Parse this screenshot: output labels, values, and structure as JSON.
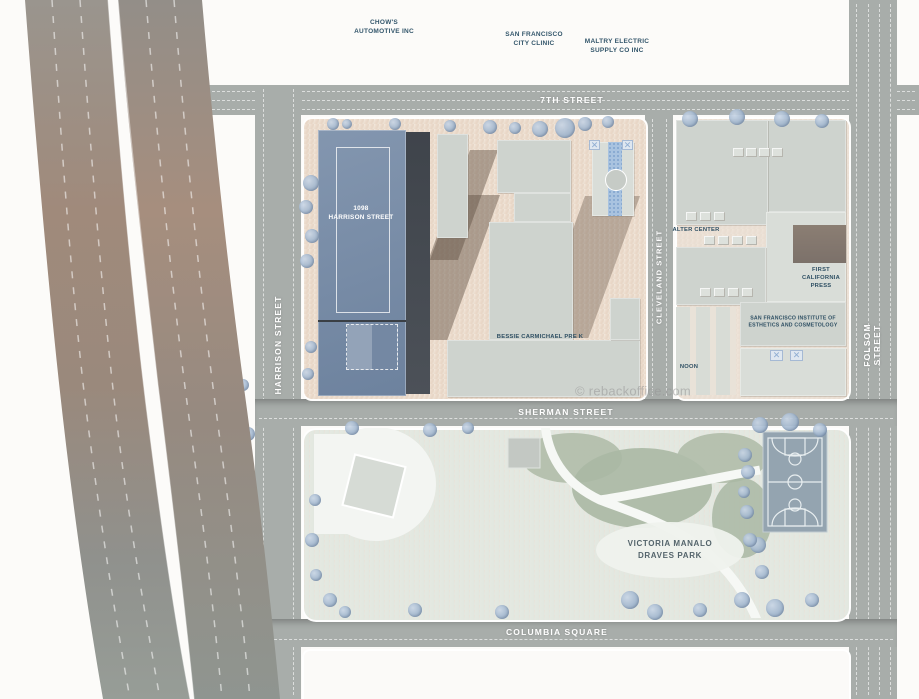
{
  "map": {
    "streets": {
      "seventh": "7TH STREET",
      "harrison": "HARRISON STREET",
      "cleveland": "CLEVELAND STREET",
      "folsom": "FOLSOM STREET",
      "sherman": "SHERMAN STREET",
      "columbia": "COLUMBIA SQUARE"
    },
    "freeways": {
      "james_lick": "JAMES LICK FREEWAY",
      "bayshore": "BAYSHORE FREEWAY"
    },
    "businesses": [
      {
        "name": "CHOW'S\nAUTOMOTIVE INC"
      },
      {
        "name": "SAN FRANCISCO\nCITY CLINIC"
      },
      {
        "name": "MALTRY ELECTRIC\nSUPPLY CO INC"
      }
    ],
    "buildings": {
      "harrison1098": "1098\nHARRISON STREET",
      "bessie": "BESSIE CARMICHAEL PRE K",
      "alter": "ALTER CENTER",
      "fcp": "FIRST\nCALIFORNIA\nPRESS",
      "institute": "SAN FRANCISCO INSTITUTE OF\nESTHETICS AND COSMETOLOGY",
      "noon": "NOON"
    },
    "park": {
      "name": "VICTORIA MANALO\nDRAVES PARK"
    },
    "watermark": "© rebackoffice.com",
    "colors": {
      "building_blue": "#7589a4",
      "road_gray": "#a8adaa",
      "block_tan": "#ecdccd",
      "park_green": "#e2e7e0",
      "tree_blue": "#9db4cf",
      "court_blue": "#94a4b0",
      "label_teal": "#33566b"
    }
  }
}
